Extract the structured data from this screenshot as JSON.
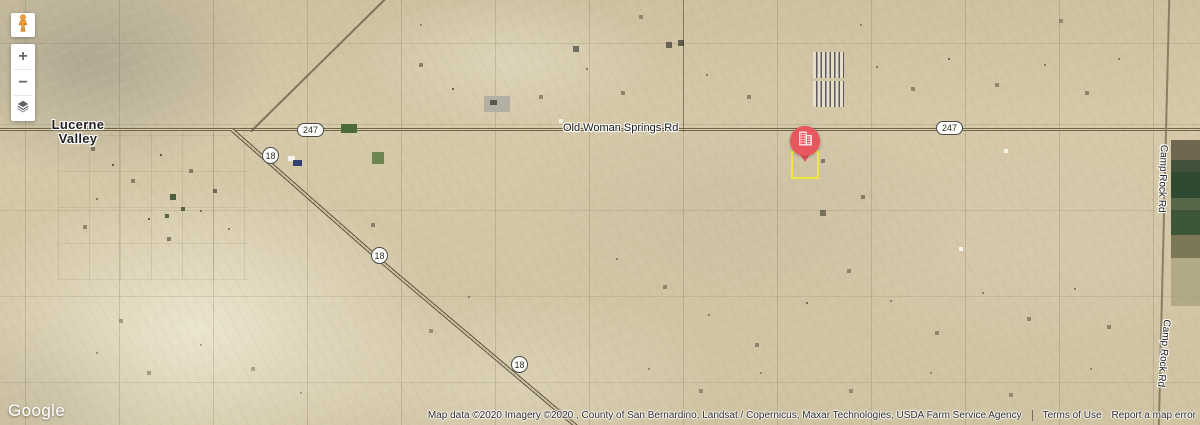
{
  "controls": {
    "zoom_in_label": "+",
    "zoom_out_label": "−"
  },
  "map_labels": {
    "place": {
      "line1": "Lucerne",
      "line2": "Valley"
    },
    "old_woman_springs_rd": "Old Woman Springs Rd",
    "camp_rock_rd_north": "Camp Rock Rd",
    "camp_rock_rd_south": "Camp Rock Rd",
    "shields": {
      "route_247_west": "247",
      "route_247_east": "247",
      "route_18_upper": "18",
      "route_18_middle": "18",
      "route_18_lower": "18"
    }
  },
  "marker": {
    "pin_color": "#e8565e",
    "icon": "building-icon",
    "parcel_outline_color": "#f4e73b"
  },
  "footer": {
    "logo_text": "Google",
    "attribution": "Map data ©2020 Imagery ©2020 , County of San Bernardino, Landsat / Copernicus, Maxar Technologies, USDA Farm Service Agency",
    "terms_link": "Terms of Use",
    "report_link": "Report a map error"
  }
}
